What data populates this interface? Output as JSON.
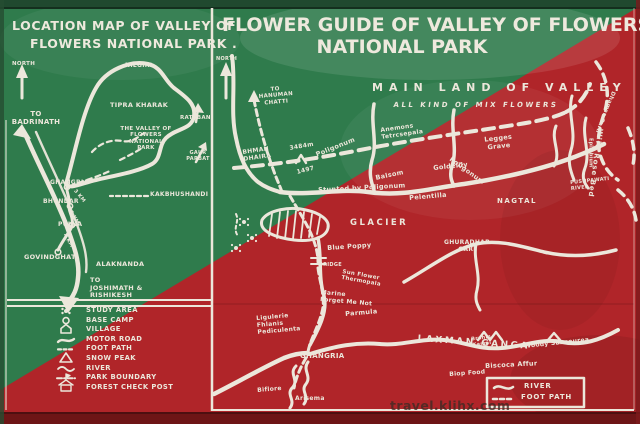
{
  "colors": {
    "board_green": "#2f7b4c",
    "board_red": "#b02529",
    "paint_white": "#ece7db",
    "frame_dark_green": "#20492f",
    "frame_dark_red": "#6d1516"
  },
  "watermark": "travel.klihx.com",
  "left_map": {
    "title_line1": "LOCATION MAP OF VALLEY OF",
    "title_line2": "FLOWERS NATIONAL PARK .",
    "north_label": "NORTH",
    "labels": {
      "to_badrinath": "TO\nBADRINATH",
      "nilgiri": "NILGIRI",
      "tipra_kharak": "TIPRA KHARAK",
      "rataban": "RATABAN",
      "valley_of_flowers": "THE VALLEY OF\nFLOWERS NATIONAL\nPARK",
      "gaur_parbat": "GAUR\nPARBAT",
      "kakbhushandi": "KAKBHUSHANDI",
      "ghangria": "GHANGRIA",
      "dist_ghangria_bhundar": "3 KM",
      "bhundar": "BHUNDAR",
      "dist_bhundar_pulna": "6 KM",
      "pulna": "PULNA",
      "dist_pulna_govindghat": "4 KM",
      "govindghat": "GOVINDGHAT",
      "alaknanda": "ALAKNANDA",
      "to_joshimath": "TO\nJOSHIMATH &\nRISHIKESH"
    },
    "legend_items": [
      "STUDY AREA",
      "BASE CAMP",
      "VILLAGE",
      "MOTOR ROAD",
      "FOOT PATH",
      "SNOW PEAK",
      "RIVER",
      "PARK BOUNDARY",
      "FOREST CHECK POST"
    ]
  },
  "right_map": {
    "title_line1": "FLOWER GUIDE OF VALLEY OF FLOWERS",
    "title_line2": "NATIONAL PARK",
    "north_label": "NORTH",
    "region_heading": "MAIN LAND OF VALLEY",
    "region_subheading": "ALL KIND OF MIX FLOWERS",
    "labels": {
      "to_hanuman_chatti": "TO\nHANUMAN\nCHATTI",
      "bhman_dhaira": "BHMAN\nDHAIRA",
      "elevation_3484": "3484m",
      "elevation_1497": "1497",
      "poligonum_upper": "Poligonum",
      "anemons": "Anemons\nTetrcsepala",
      "balsom": "Balsom",
      "poligonum_lower": "Poligonum",
      "stunted_by_poligonum": "Stunted by Poligonum",
      "legges_grave": "Legges\nGrave",
      "goldelily": "Goldelily",
      "wild_rose_bed": "Wild Rose Bed",
      "epilobium": "Epilobium",
      "dhamar_garh": "Dhamar Garh",
      "pushpawati_river": "PUSHPAWATI\nRIVER",
      "pelentilla": "Pelentilla",
      "nagtal": "NAGTAL",
      "ghuradhar_gari": "GHURADHAR\nGARI",
      "glacier": "GLACIER",
      "blue_poppy": "Blue Poppy",
      "bridge": "BRIDGE",
      "sun_flower_thermopala": "Sun Flower\nThermopala",
      "marine_forget_me_not": "Marine\nForget Me Not",
      "parmula": "Parmula",
      "ligulerie": "Ligulerie\nFhlanis\nPediculenta",
      "ghangria": "GHANGRIA",
      "laxman_ganga": "LAXMAN GANGA",
      "brahm_kamal": "Brahm\nKamal",
      "woody_sansourea": "Woody Sansourea",
      "biscoca_affur": "Biscoca Affur",
      "biop_food": "Biop Food",
      "biflore": "Biflore",
      "arisema": "Arisema"
    },
    "legend": {
      "river": "RIVER",
      "foot_path": "FOOT PATH"
    }
  }
}
